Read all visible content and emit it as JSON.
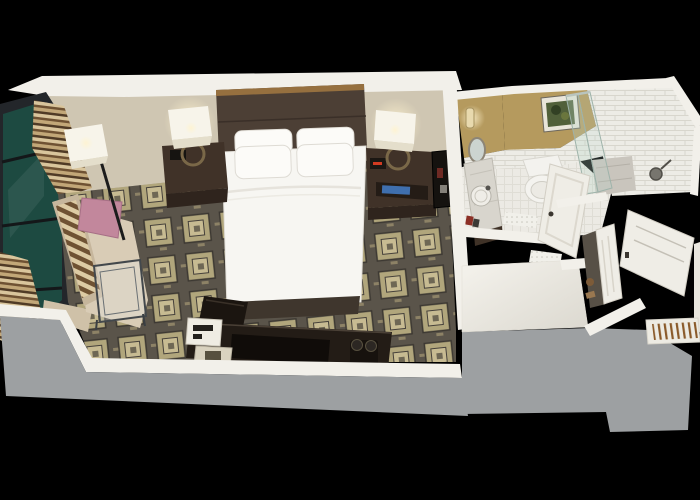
{
  "scene": {
    "type": "3d-room-render",
    "description": "Isometric cutaway 3D rendering of a hotel guest room: bedroom with double bed, dark wood headboard, two nightstands with lamps, chaise sofa with pink pillow beside a tall window with striped curtains, glass coffee table, dark media console with coffee maker, en-suite bathroom with marble vanity, round mirror, toilet, glass shower with marble floor, framed art on tan wall, and an entry corridor with white paneled doors and a wooden luggage rack.",
    "visible_text": "none"
  },
  "palette": {
    "background": "#000000",
    "outer_wall_gray": "#9da0a2",
    "wall_cap_white": "#f2f0ea",
    "bedroom_wall_beige": "#cfc6b2",
    "bathroom_wall_tan": "#b59a5e",
    "tile_white": "#edece6",
    "tile_line": "#d8d6cd",
    "bath_floor": "#eceae4",
    "bath_floor_line": "#dfddd5",
    "carpet_grid": "#5a544a",
    "carpet_dash": "#8d8266",
    "carpet_square": "#b1a67c",
    "carpet_square_inner": "#c7bb92",
    "carpet_square_center": "#6e6754",
    "bed_white": "#f7f6f2",
    "pillow_white": "#fcfbf8",
    "headboard_brown": "#4c3f35",
    "wood_trim": "#96703f",
    "nightstand_brown": "#403228",
    "nightstand_front": "#2f241d",
    "sofa_beige": "#d9ccb6",
    "sofa_back_beige": "#c6b69c",
    "pillow_pink": "#c2879c",
    "window_teal": "#1d4a41",
    "window_frame": "#23262a",
    "curtain_light": "#d9c59c",
    "curtain_dark": "#6f5233",
    "curtain_mid": "#c2a778",
    "curtain_deep": "#503b26",
    "console_dark": "#231c16",
    "door_white": "#efede6",
    "glass_tint": "#bad6cb",
    "marble": "#d8d5cd",
    "shower_marble": "#c9c5bd",
    "art_green": "#51603a",
    "lamp_shade": "#f7f4ea",
    "glow": "#fff3cf",
    "magazine_blue": "#3f6fae",
    "clock_red": "#d23b22",
    "slat_brown": "#8a5a2a"
  }
}
